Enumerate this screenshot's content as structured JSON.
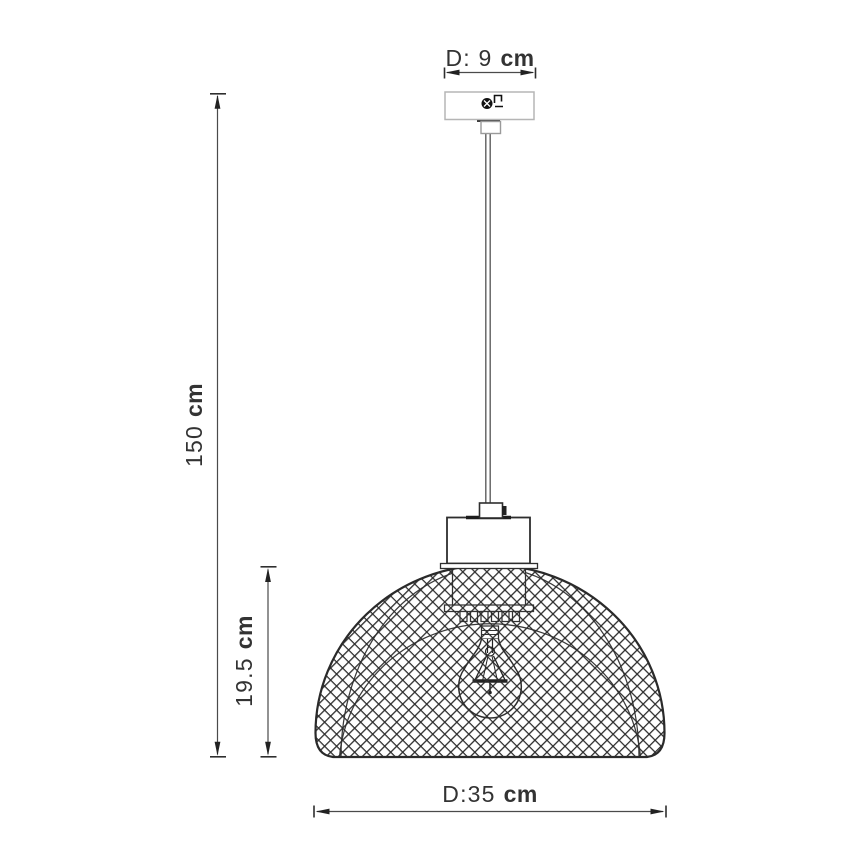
{
  "diagram": {
    "kind": "technical-dimension-drawing",
    "subject": "pendant lamp with crosshatch mesh dome shade and exposed bulb",
    "labels": {
      "canopy_diameter": {
        "value": "D: 9",
        "unit": "cm"
      },
      "total_height": {
        "value": "150",
        "unit": "cm"
      },
      "shade_height": {
        "value": "19.5",
        "unit": "cm"
      },
      "shade_diameter": {
        "value": "D:35",
        "unit": "cm"
      }
    },
    "colors": {
      "background": "#ffffff",
      "primary_line": "#2a2a2a",
      "mesh_line": "#2d2d2d",
      "light_line": "#b5b5b5",
      "cord_line": "#5f5f5f",
      "dimension_line": "#4a4a4a",
      "text": "#333333"
    }
  }
}
